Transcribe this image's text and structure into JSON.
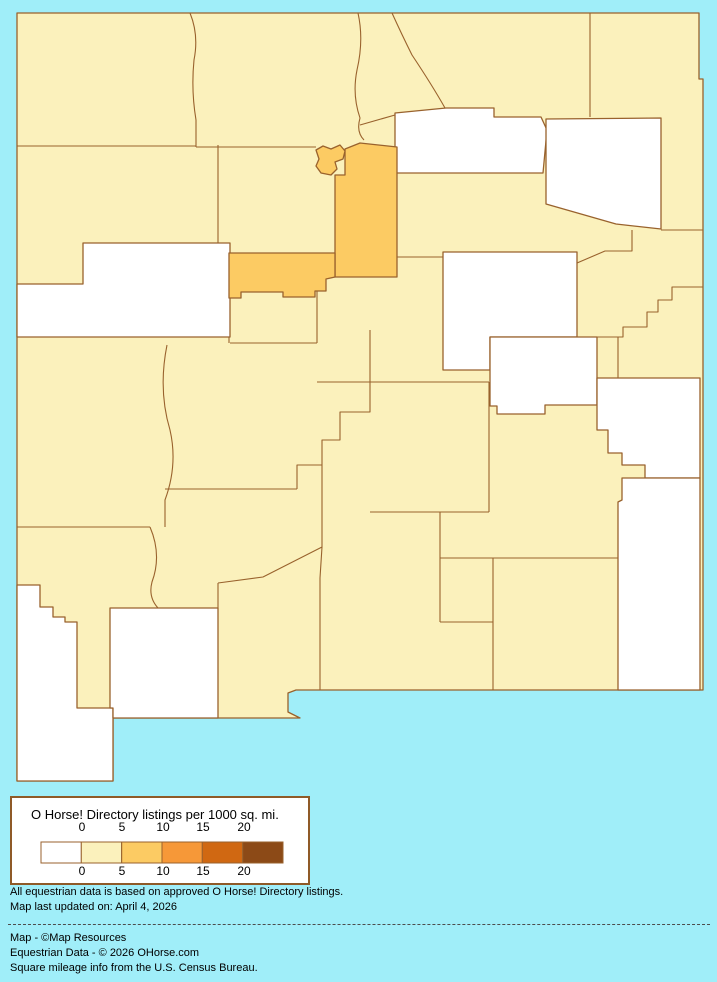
{
  "colors": {
    "background": "#A0EEF9",
    "map_border": "#99622D",
    "class_0": "#FFFFFF",
    "class_0_5": "#FBF1BC",
    "class_5_10": "#FCCB63",
    "class_10_15": "#F69838",
    "class_15_20": "#D06812",
    "class_20_plus": "#8C4A17",
    "legend_box_background": "#FFFFFF",
    "dashed_line": "#4D4D4D"
  },
  "legend": {
    "title": "O Horse! Directory listings per 1000 sq. mi.",
    "ticks_top": [
      "0",
      "5",
      "10",
      "15",
      "20"
    ],
    "ticks_bottom": [
      "0",
      "5",
      "10",
      "15",
      "20"
    ],
    "swatches": [
      "#FFFFFF",
      "#FBF1BC",
      "#FCCB63",
      "#F69838",
      "#D06812",
      "#8C4A17"
    ]
  },
  "footer": {
    "note1": "All equestrian data is based on approved O Horse! Directory listings.",
    "note2": "Map last updated on: April 4, 2026",
    "credit1": "Map - ©Map Resources",
    "credit2": "Equestrian Data - © 2026 OHorse.com",
    "credit3": "Square mileage info from the U.S. Census Bureau."
  },
  "map": {
    "state": "New Mexico",
    "unit": "listings per 1000 sq. mi.",
    "counties": [
      {
        "name": "San Juan",
        "class": "0-5"
      },
      {
        "name": "Rio Arriba",
        "class": "0-5"
      },
      {
        "name": "Taos",
        "class": "0-5"
      },
      {
        "name": "Colfax",
        "class": "0-5"
      },
      {
        "name": "Union",
        "class": "0-5"
      },
      {
        "name": "McKinley",
        "class": "0-5"
      },
      {
        "name": "Sandoval",
        "class": "0-5"
      },
      {
        "name": "Los Alamos",
        "class": "5-10"
      },
      {
        "name": "Santa Fe",
        "class": "5-10"
      },
      {
        "name": "Mora",
        "class": "0"
      },
      {
        "name": "Harding",
        "class": "0"
      },
      {
        "name": "San Miguel",
        "class": "0-5"
      },
      {
        "name": "Cibola",
        "class": "0"
      },
      {
        "name": "Bernalillo",
        "class": "5-10"
      },
      {
        "name": "Valencia",
        "class": "0-5"
      },
      {
        "name": "Torrance",
        "class": "0-5"
      },
      {
        "name": "Guadalupe",
        "class": "0"
      },
      {
        "name": "Quay",
        "class": "0-5"
      },
      {
        "name": "Curry",
        "class": "0-5"
      },
      {
        "name": "De Baca",
        "class": "0"
      },
      {
        "name": "Roosevelt",
        "class": "0"
      },
      {
        "name": "Socorro",
        "class": "0-5"
      },
      {
        "name": "Catron",
        "class": "0-5"
      },
      {
        "name": "Lincoln",
        "class": "0-5"
      },
      {
        "name": "Chaves",
        "class": "0-5"
      },
      {
        "name": "Lea",
        "class": "0"
      },
      {
        "name": "Eddy",
        "class": "0-5"
      },
      {
        "name": "Otero",
        "class": "0-5"
      },
      {
        "name": "Sierra",
        "class": "0-5"
      },
      {
        "name": "Grant",
        "class": "0-5"
      },
      {
        "name": "Hidalgo",
        "class": "0"
      },
      {
        "name": "Luna",
        "class": "0"
      },
      {
        "name": "Dona Ana",
        "class": "0-5"
      }
    ]
  }
}
